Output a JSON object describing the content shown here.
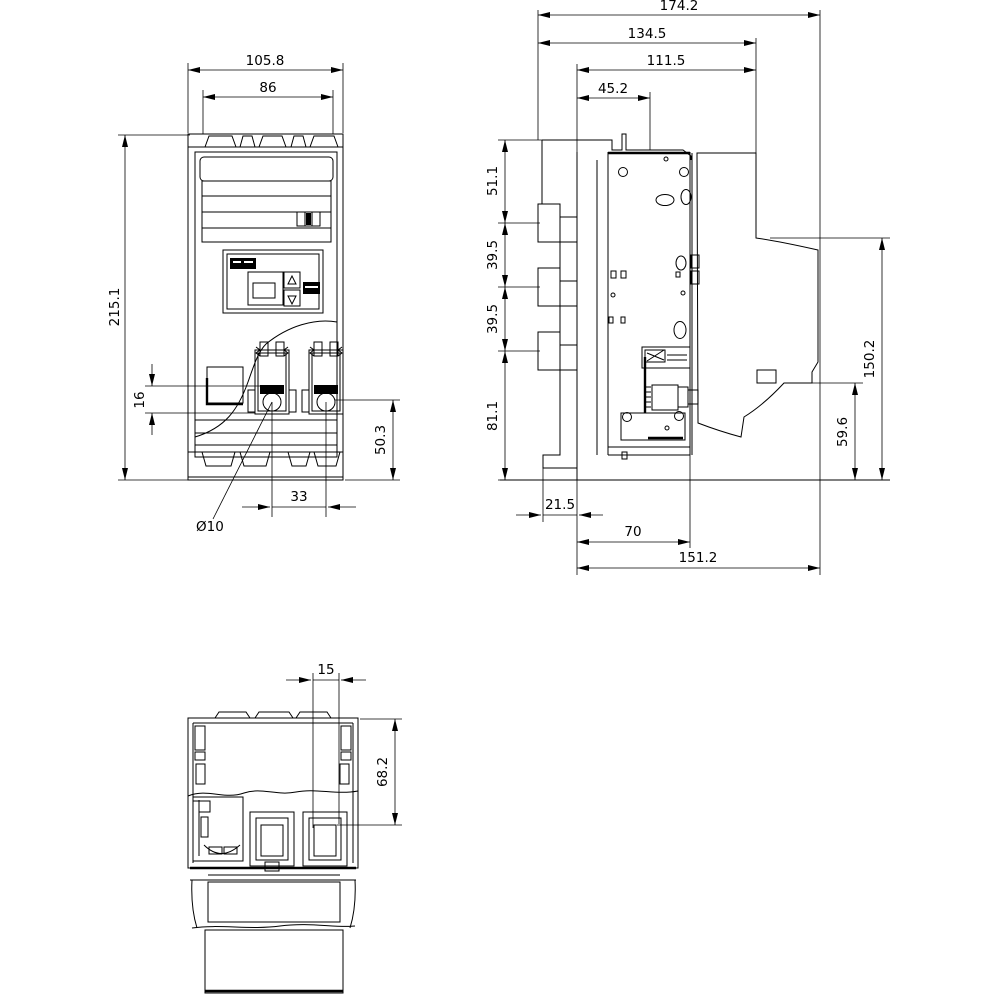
{
  "document": {
    "kind": "technical-dimension-drawing",
    "colors": {
      "line": "#000000",
      "background": "#ffffff"
    }
  },
  "views": {
    "front": {
      "name": "front-view",
      "dims": {
        "overall_width": "105.8",
        "mounting_width": "86",
        "overall_height": "215.1",
        "terminal_height": "16",
        "base_height": "50.3",
        "hole_spacing": "33",
        "hole_diameter": "Ø10"
      }
    },
    "side": {
      "name": "side-view",
      "dims": {
        "overall_depth": "174.2",
        "depth_to_rear_face": "134.5",
        "upper_depth": "111.5",
        "front_section_depth": "45.2",
        "top_section_height": "51.1",
        "pole_pitch_upper": "39.5",
        "pole_pitch_lower": "39.5",
        "lower_section_height": "81.1",
        "rear_height": "150.2",
        "rear_lower_height": "59.6",
        "base_front_offset": "21.5",
        "base_depth": "70",
        "base_overall_depth": "151.2"
      }
    },
    "bottom": {
      "name": "bottom-view",
      "dims": {
        "slot_width": "15",
        "section_depth": "68.2"
      }
    }
  }
}
